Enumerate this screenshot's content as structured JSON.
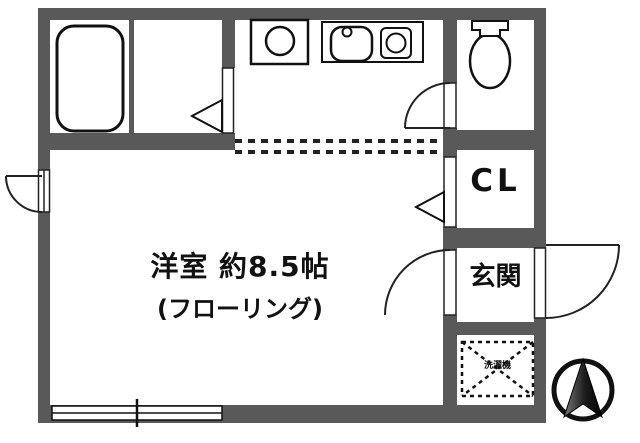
{
  "plan": {
    "rooms": {
      "main_room_label": "洋室 約8.5帖",
      "main_room_sublabel": "(フローリング)",
      "closet_label": "CL",
      "entrance_label": "玄関",
      "equipment_box_label": "洗濯機"
    },
    "fixtures": [
      "bathtub-icon",
      "washing-machine-icon",
      "kitchen-sink-icon",
      "faucet-icon",
      "stove-burner-icon",
      "toilet-icon",
      "north-compass-icon",
      "sliding-window",
      "entrance-door-arc",
      "interior-door-arc",
      "closet-door-triangle",
      "washroom-door-triangle",
      "dashed-room-boundary",
      "equipment-dashed-box"
    ],
    "colors": {
      "wall": "#595959",
      "line": "#111111",
      "background": "#ffffff"
    }
  }
}
